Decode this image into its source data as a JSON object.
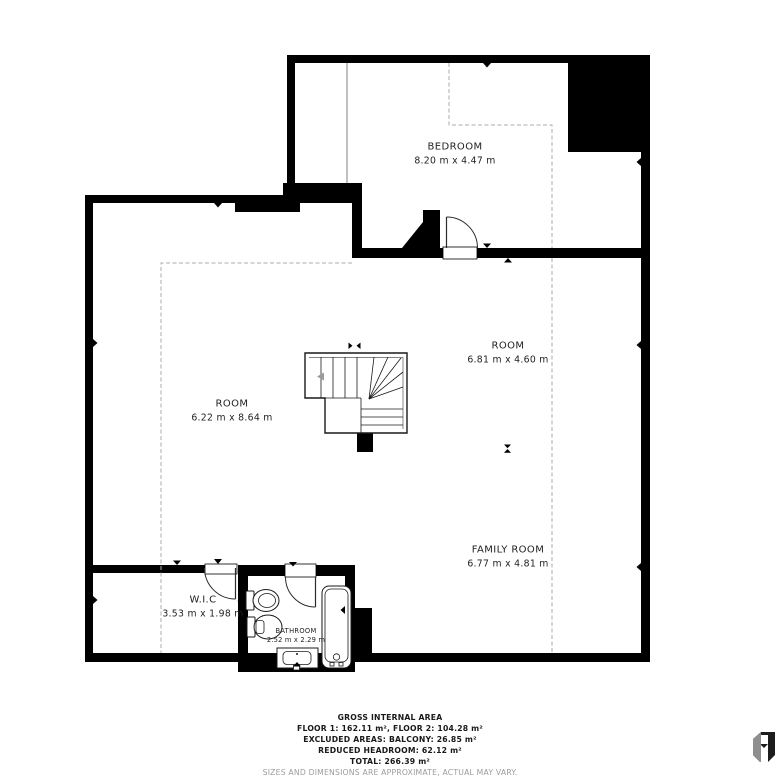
{
  "plan": {
    "rooms": [
      {
        "name": "BEDROOM",
        "dims": "8.20 m x 4.47 m"
      },
      {
        "name": "ROOM",
        "dims": "6.81 m x 4.60 m"
      },
      {
        "name": "ROOM",
        "dims": "6.22 m x 8.64 m"
      },
      {
        "name": "FAMILY ROOM",
        "dims": "6.77 m x 4.81 m"
      },
      {
        "name": "W.I.C",
        "dims": "3.53 m x 1.98 m"
      },
      {
        "name": "BATHROOM",
        "dims": "2.52 m x 2.29 m"
      }
    ]
  },
  "footer": {
    "title": "GROSS INTERNAL AREA",
    "floors": "FLOOR 1: 162.11 m², FLOOR 2: 104.28 m²",
    "excluded": "EXCLUDED AREAS: BALCONY: 26.85 m²",
    "reduced": "REDUCED HEADROOM: 62.12 m²",
    "total": "TOTAL: 266.39 m²",
    "disclaimer": "SIZES AND DIMENSIONS ARE APPROXIMATE, ACTUAL MAY VARY."
  },
  "icons": {
    "logo": "matterport-logo",
    "stair_direction": "stair-direction-arrow",
    "measure_markers": "dimension-marker"
  },
  "colors": {
    "wall": "#000000",
    "dashed_boundary": "#ababab",
    "text": "#1c1c1c",
    "muted_text": "#9c9c9c",
    "fixture_stroke": "#1a1a1a"
  }
}
